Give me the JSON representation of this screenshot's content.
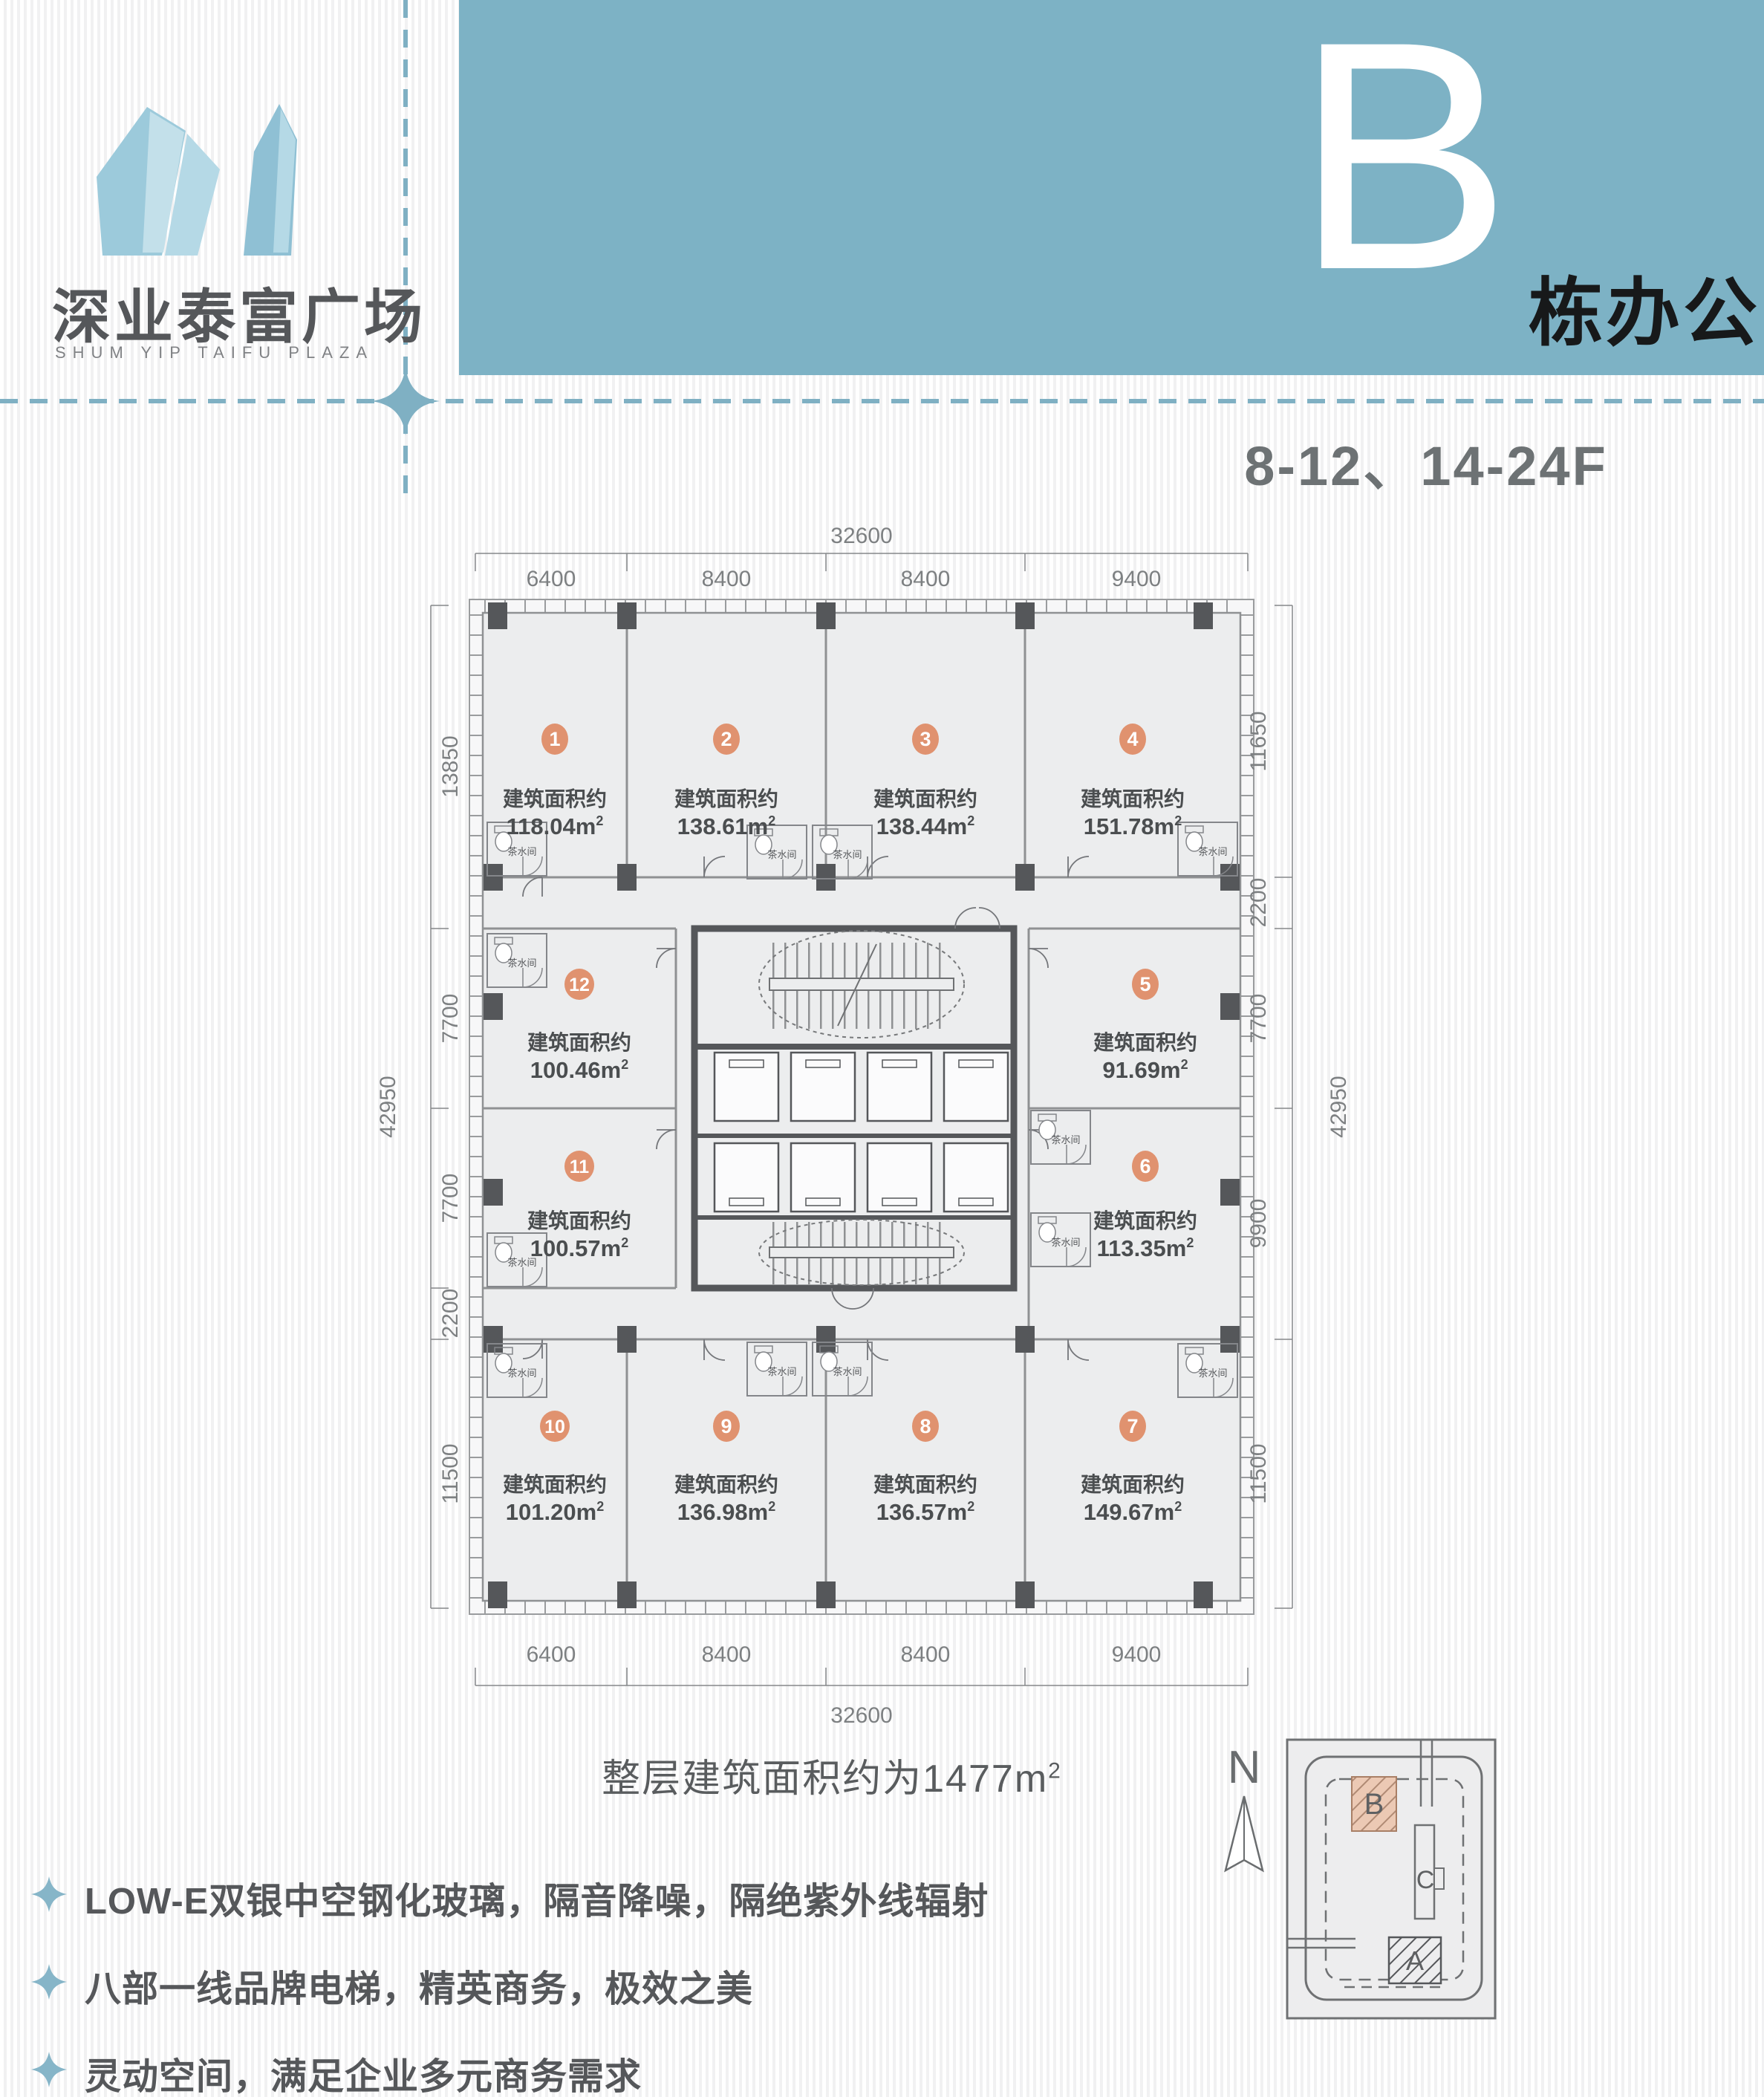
{
  "logo": {
    "title": "深业泰富广场",
    "subtitle": "SHUM YIP TAIFU PLAZA"
  },
  "banner": {
    "letter": "B",
    "suffix": "栋办公",
    "floors": "8-12、14-24F",
    "color": "#7db2c5"
  },
  "plan": {
    "area_label": "建筑面积约",
    "sup": "2",
    "tearoom": "茶水间",
    "badge_color": "#e0926f",
    "units": [
      {
        "no": "1",
        "area": "118.04m"
      },
      {
        "no": "2",
        "area": "138.61m"
      },
      {
        "no": "3",
        "area": "138.44m"
      },
      {
        "no": "4",
        "area": "151.78m"
      },
      {
        "no": "5",
        "area": "91.69m"
      },
      {
        "no": "6",
        "area": "113.35m"
      },
      {
        "no": "7",
        "area": "149.67m"
      },
      {
        "no": "8",
        "area": "136.57m"
      },
      {
        "no": "9",
        "area": "136.98m"
      },
      {
        "no": "10",
        "area": "101.20m"
      },
      {
        "no": "11",
        "area": "100.57m"
      },
      {
        "no": "12",
        "area": "100.46m"
      }
    ],
    "dims": {
      "top": {
        "overall": "32600",
        "segments": [
          "6400",
          "8400",
          "8400",
          "9400"
        ]
      },
      "bottom": {
        "overall": "32600",
        "segments": [
          "6400",
          "8400",
          "8400",
          "9400"
        ]
      },
      "left": {
        "overall": "42950",
        "segments": [
          "13850",
          "7700",
          "7700",
          "2200",
          "11500"
        ]
      },
      "right": {
        "overall": "42950",
        "segments": [
          "11650",
          "2200",
          "7700",
          "9900",
          "11500"
        ]
      }
    },
    "total_note": {
      "text": "整层建筑面积约为1477",
      "unit": "m",
      "sup": "2"
    }
  },
  "features": [
    {
      "text": "LOW-E双银中空钢化玻璃，隔音降噪，隔绝紫外线辐射"
    },
    {
      "text": "八部一线品牌电梯，精英商务，极效之美"
    },
    {
      "text": "灵动空间，满足企业多元商务需求"
    }
  ],
  "site_plan": {
    "north": "N",
    "buildings": [
      {
        "label": "B"
      },
      {
        "label": "C"
      },
      {
        "label": "A"
      }
    ]
  }
}
